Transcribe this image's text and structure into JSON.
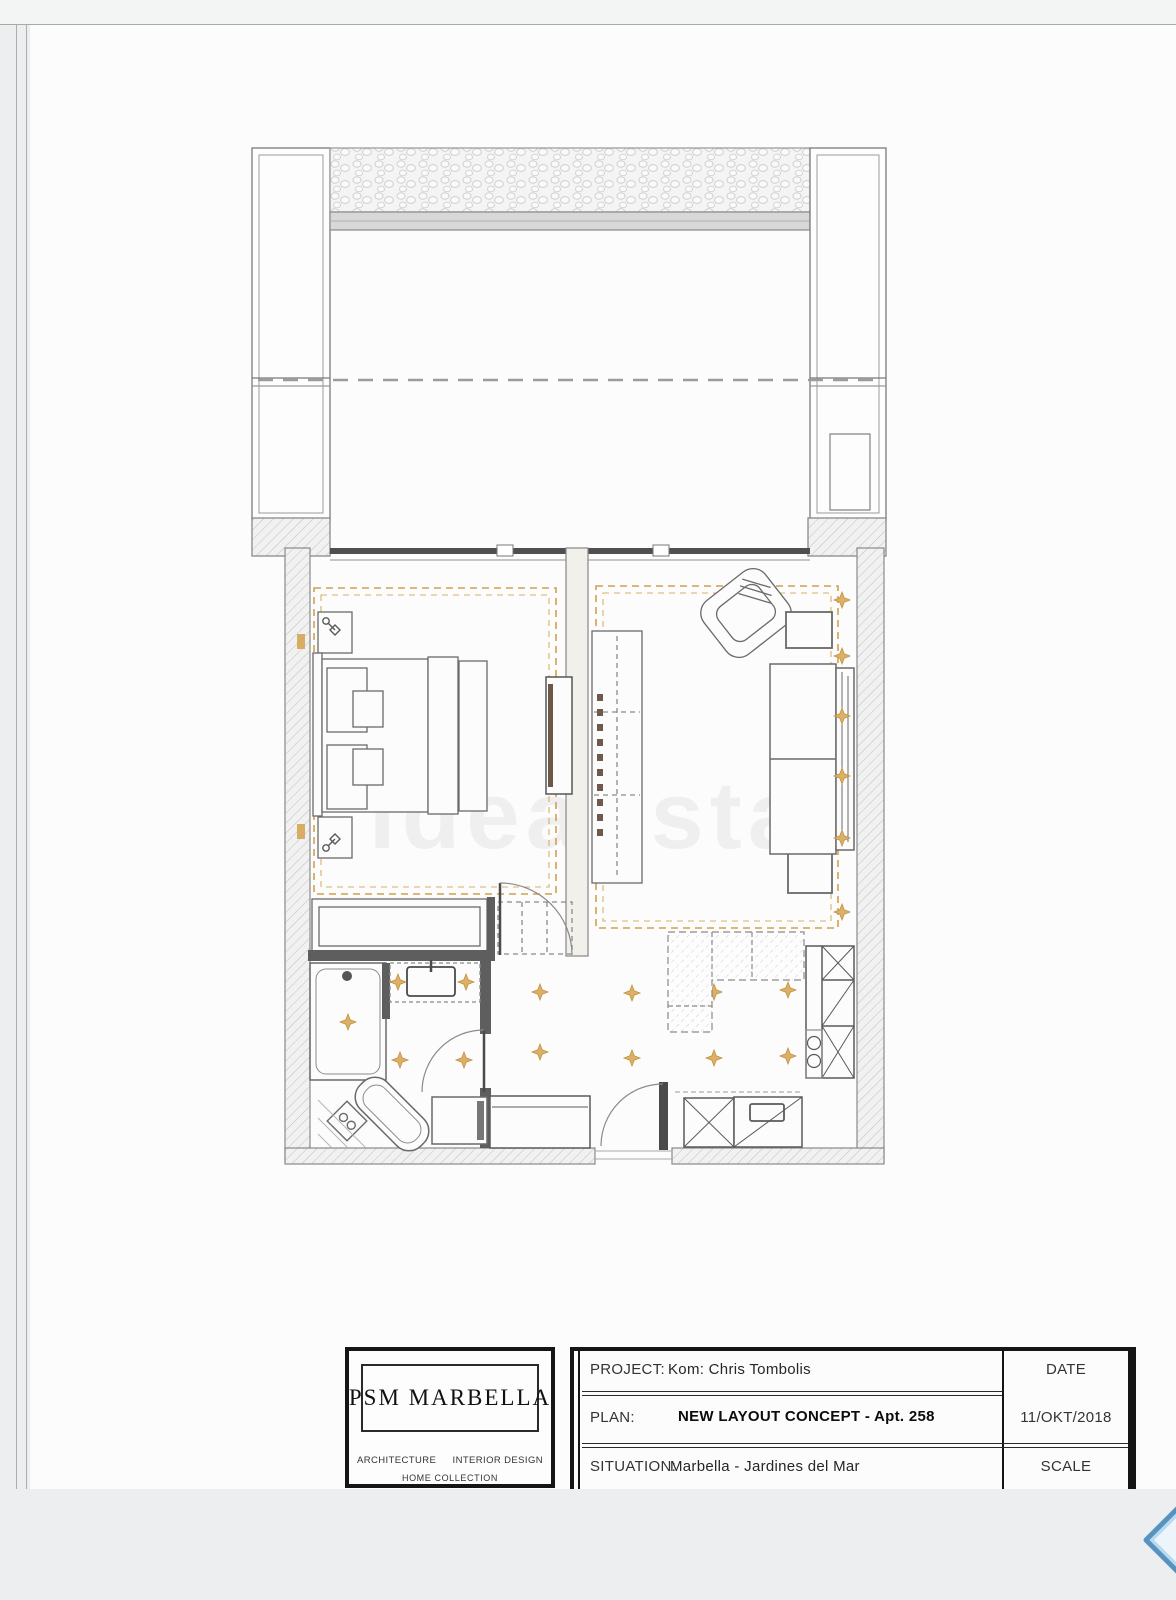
{
  "title_block": {
    "logo": {
      "name": "PSM  MARBELLA",
      "tagline_left": "ARCHITECTURE",
      "tagline_right": "INTERIOR DESIGN",
      "tagline_bottom": "HOME COLLECTION"
    },
    "rows": [
      {
        "label": "PROJECT:",
        "value": "Kom: Chris Tombolis"
      },
      {
        "label": "PLAN:",
        "value": "NEW LAYOUT CONCEPT  -  Apt. 258"
      },
      {
        "label": "SITUATION:",
        "value": "Marbella  -  Jardines del Mar"
      }
    ],
    "meta": {
      "date_label": "DATE",
      "date_value": "11/OKT/2018",
      "scale_label": "SCALE"
    }
  },
  "watermark": "idealista",
  "colors": {
    "accent_dash": "#d2a24b",
    "diamond_fill": "#ddb069",
    "wall_line": "#6e6e6e",
    "dark_wall": "#4a4a4a",
    "blue_arrow_stroke": "#4f8fbe",
    "sheet": "#fcfcfc",
    "background": "#edeef0"
  },
  "icons": {
    "nav": "chevron-left-diamond-icon"
  }
}
